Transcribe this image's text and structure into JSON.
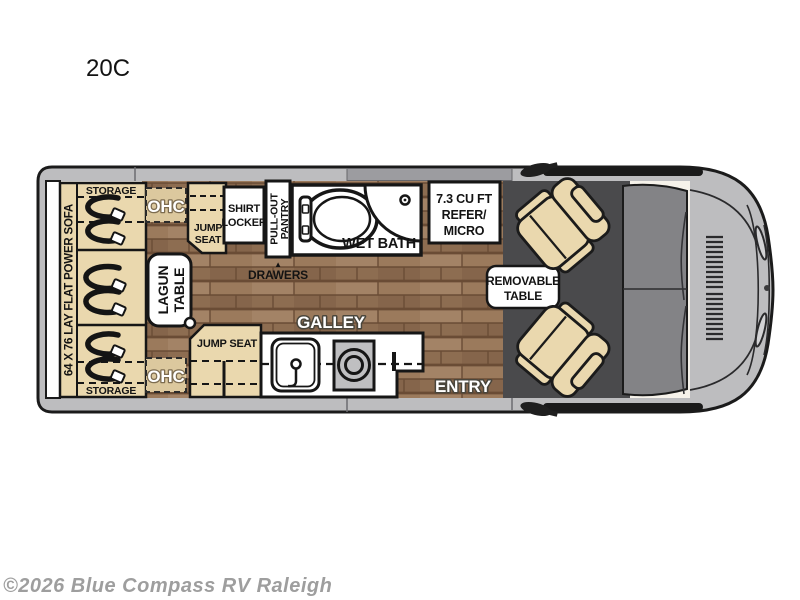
{
  "title": "20C",
  "watermark": "©2026 Blue Compass RV Raleigh",
  "colors": {
    "seat_tan": "#ead8ae",
    "wood": "#9b7a5c",
    "cab_floor": "#4a4a4c",
    "windshield": "#838386",
    "van_body": "#bdbdbf",
    "outline": "#1b1b1b",
    "counter": "#ffffff"
  },
  "labels": {
    "storage_top": "STORAGE",
    "storage_bottom": "STORAGE",
    "sofa": "64 X 76 LAY FLAT POWER SOFA",
    "ohc_top": "OHC",
    "ohc_bottom": "OHC",
    "jump_seat_top": {
      "line1": "JUMP",
      "line2": "SEAT"
    },
    "shirt_locker": {
      "line1": "SHIRT",
      "line2": "LOCKER"
    },
    "pantry": {
      "line1": "PULL-OUT",
      "line2": "PANTRY"
    },
    "wet_bath": "WET BATH",
    "drawers": "DRAWERS",
    "drawers_arrow": "▲",
    "refer": {
      "line1": "7.3 CU FT",
      "line2": "REFER/",
      "line3": "MICRO"
    },
    "lagun_table": {
      "line1": "LAGUN",
      "line2": "TABLE"
    },
    "removable_table": {
      "line1": "REMOVABLE",
      "line2": "TABLE"
    },
    "jump_seat_bottom": "JUMP SEAT",
    "galley": "GALLEY",
    "entry": "ENTRY"
  }
}
